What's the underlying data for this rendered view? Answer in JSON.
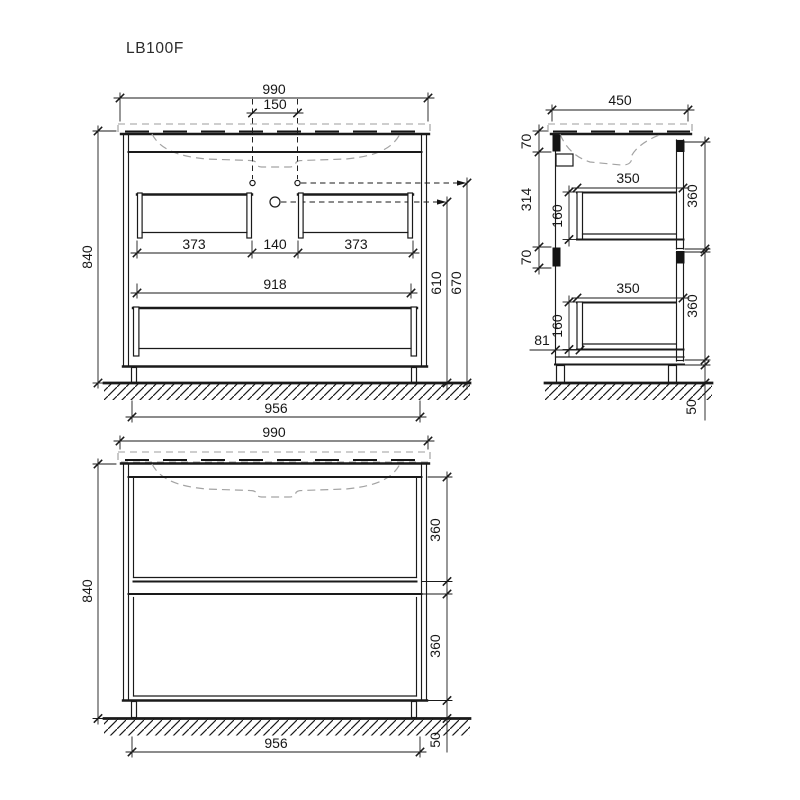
{
  "title": "LB100F",
  "units": "mm",
  "drawing": {
    "front_open": {
      "label": "front view, drawers open",
      "dims": {
        "overall_width": "990",
        "faucet_spacing": "150",
        "overall_height": "840",
        "drawer_left": "373",
        "gap": "140",
        "drawer_right": "373",
        "inner_width": "918",
        "base_width": "956",
        "drain_height": "610",
        "faucet_height": "670"
      }
    },
    "side": {
      "label": "side section view",
      "dims": {
        "overall_depth": "450",
        "top_rail": "70",
        "rail_gap": "314",
        "bottom_rail": "70",
        "box_depth_top": "350",
        "box_height_top": "160",
        "box_depth_bottom": "350",
        "box_height_bottom": "160",
        "front_top": "360",
        "front_bottom": "360",
        "back_offset": "81",
        "plinth": "50"
      }
    },
    "front_closed": {
      "label": "front view, drawers closed",
      "dims": {
        "overall_width": "990",
        "overall_height": "840",
        "front_top": "360",
        "front_bottom": "360",
        "base_width": "956",
        "plinth": "50"
      }
    }
  },
  "colors": {
    "line": "#1a1a1a",
    "secondary_dash": "#a3a3a3",
    "background": "#ffffff"
  }
}
